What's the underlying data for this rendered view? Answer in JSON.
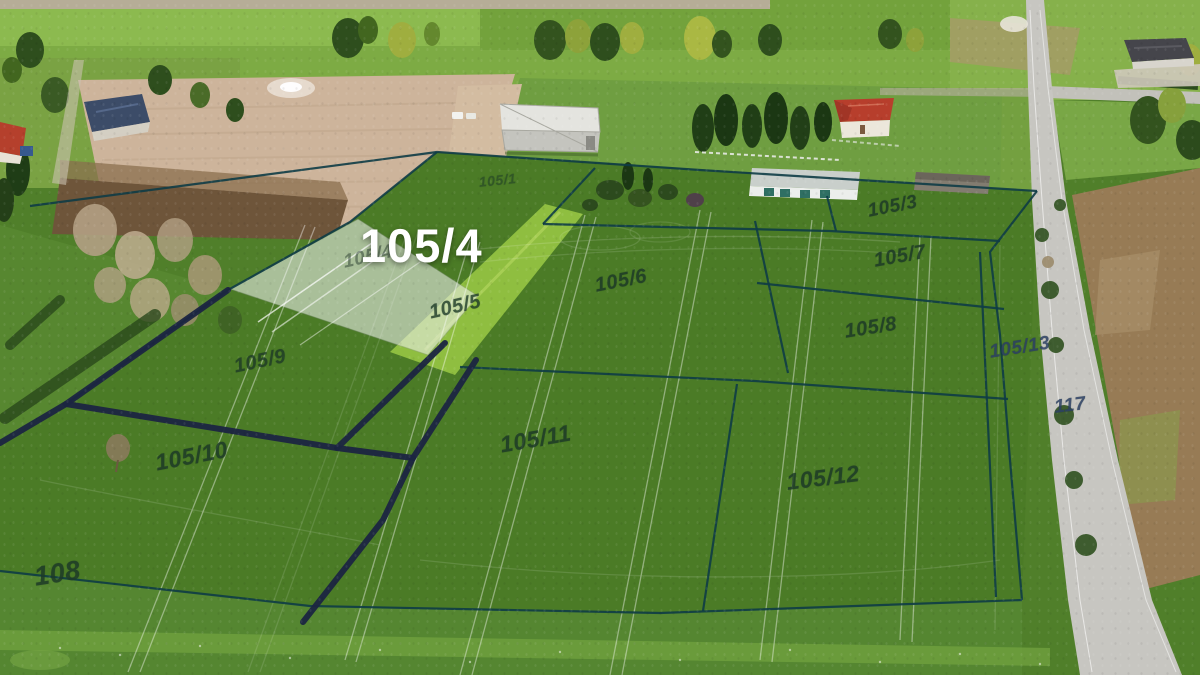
{
  "scene": {
    "type": "aerial-drone-photo",
    "subject": "subdivided land plots with overlaid parcel numbers, highlighted plot for sale"
  },
  "colors": {
    "boundary-navy": "#1b2541",
    "boundary-teal": "#0e3c46",
    "parcel-label": "#1d3a27",
    "road-label-blue": "#2b3f63",
    "highlight-label": "#ffffff",
    "highlight-fill": "#eef0ec",
    "field-green": "#4b7b26",
    "access-strip-green": "#8fbe40",
    "road-gray": "#c7c6c1",
    "bare-field-tan": "#cdb49b",
    "brown-field": "#977b55"
  },
  "parcel_map": {
    "highlighted_parcel": {
      "label": "105/4",
      "ghost_label": "105/4"
    },
    "parcel_labels": [
      {
        "label": "105/1"
      },
      {
        "label": "105/3"
      },
      {
        "label": "105/5"
      },
      {
        "label": "105/6"
      },
      {
        "label": "105/7"
      },
      {
        "label": "105/8"
      },
      {
        "label": "105/9"
      },
      {
        "label": "105/10"
      },
      {
        "label": "105/11"
      },
      {
        "label": "105/12"
      },
      {
        "label": "105/13"
      }
    ],
    "road_label": "117",
    "adjacent_parcel_label": "108"
  }
}
